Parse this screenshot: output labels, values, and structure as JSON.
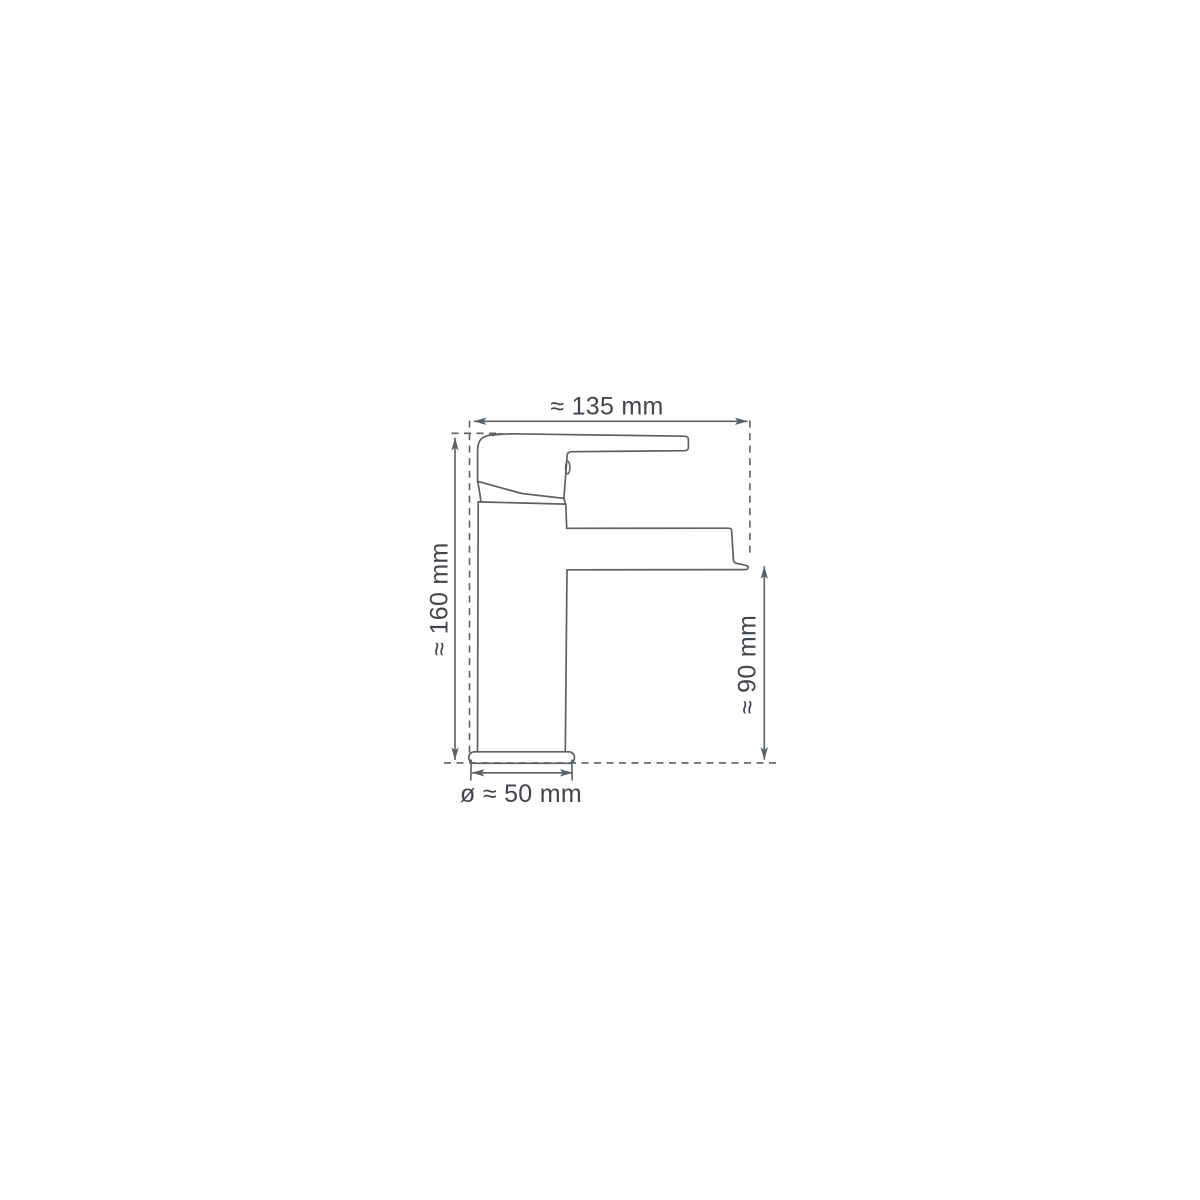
{
  "diagram": {
    "labels": {
      "width": "≈ 135 mm",
      "height": "≈ 160 mm",
      "spout_height": "≈ 90 mm",
      "base_diameter": "ø ≈ 50 mm"
    },
    "colors": {
      "line": "#5b6165",
      "text": "#41464c",
      "background": "#ffffff"
    }
  }
}
